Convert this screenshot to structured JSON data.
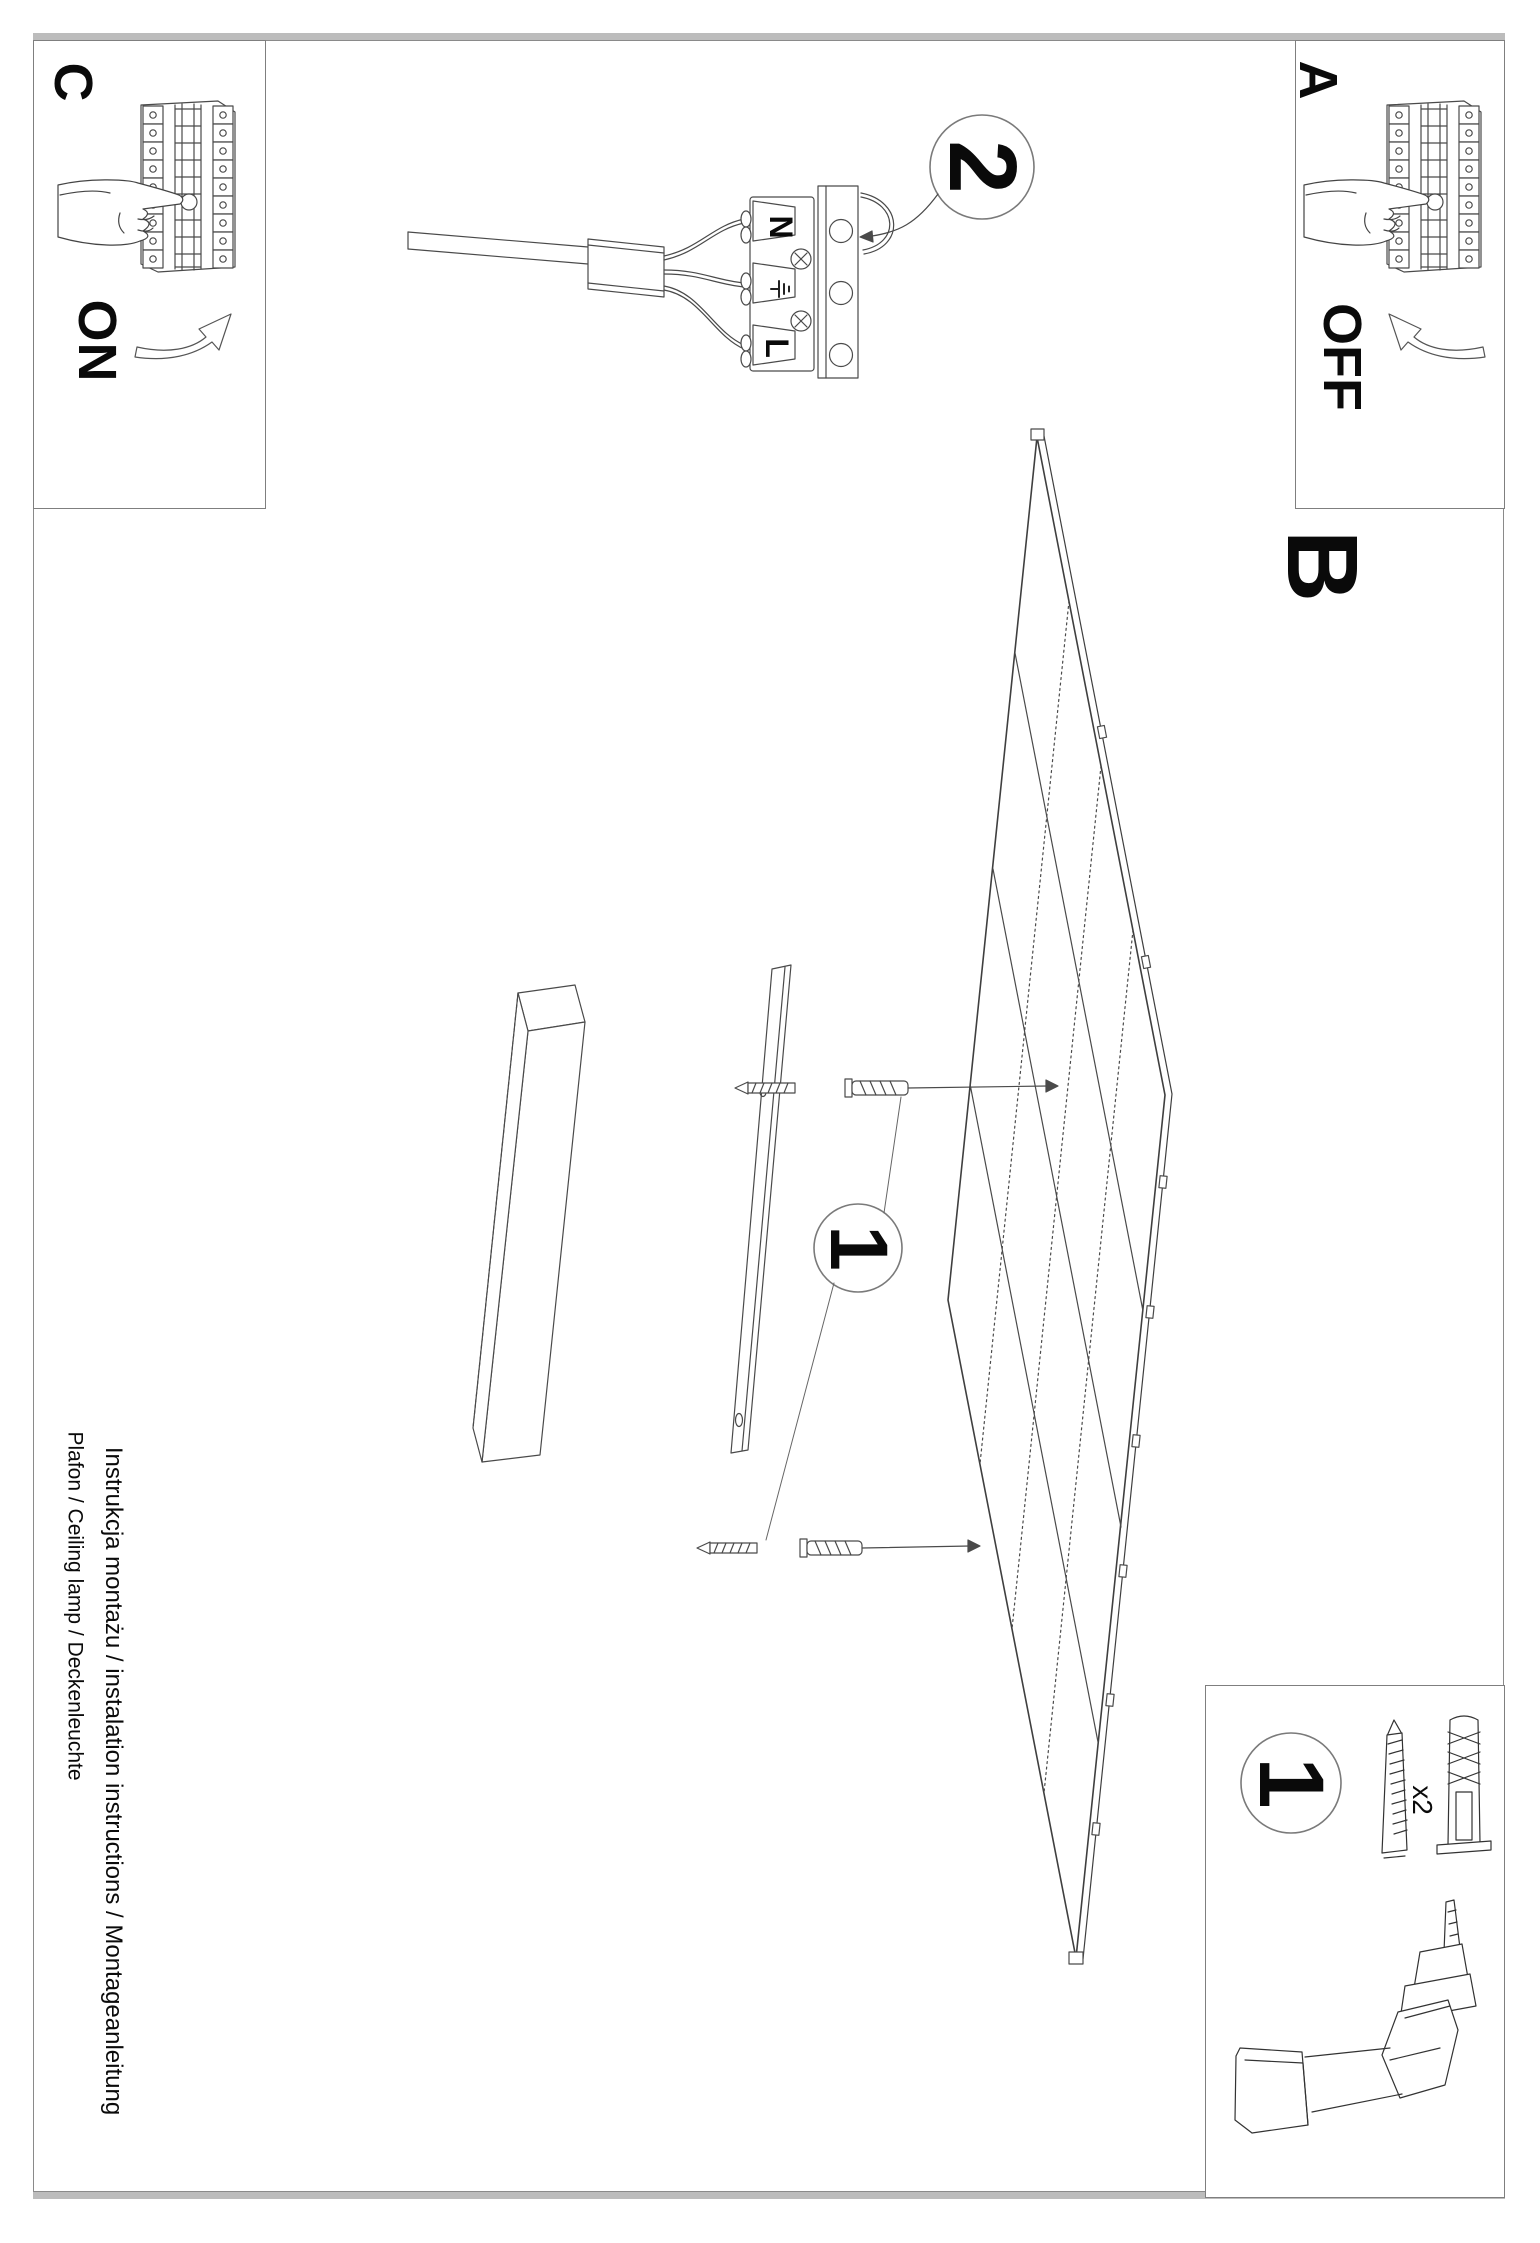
{
  "labels": {
    "step_c": "C",
    "step_a": "A",
    "step_b": "B",
    "switch_on": "ON",
    "switch_off": "OFF",
    "badge_wiring": "2",
    "badge_install": "1",
    "badge_parts": "1",
    "terminal_neutral": "N",
    "terminal_live": "L",
    "parts_qty": "x2"
  },
  "footer": {
    "line1": "Instrukcja montażu / instalation instructions / Montageanleitung",
    "line2": "Plafon / Ceiling lamp / Deckenleuchte"
  },
  "colors": {
    "ink": "#0a0a0a",
    "line": "#4a4a4a",
    "border": "#8a8a8a"
  }
}
